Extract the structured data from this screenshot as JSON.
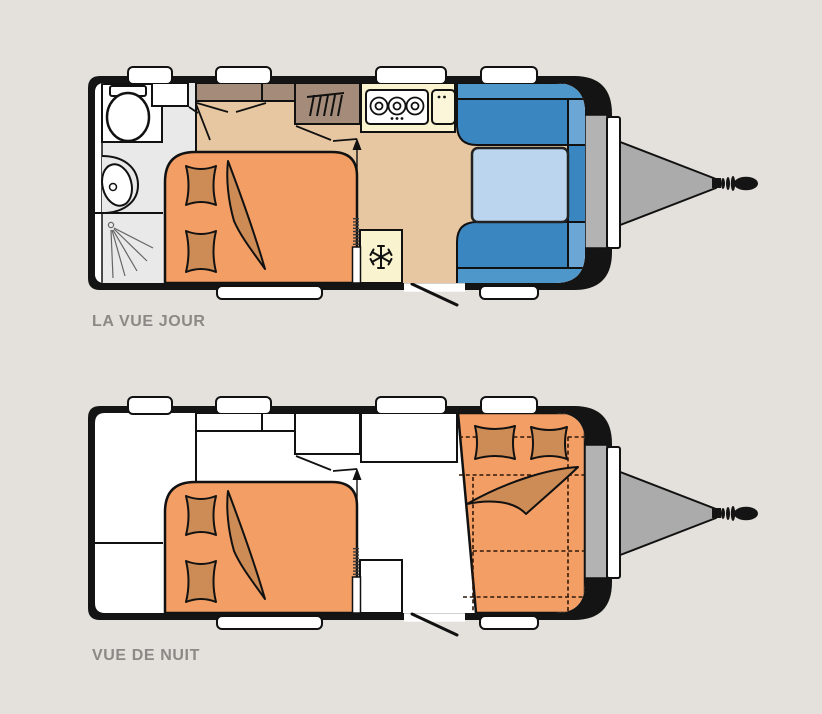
{
  "captions": {
    "day": "LA VUE JOUR",
    "night": "VUE DE NUIT"
  },
  "colors": {
    "bg": "#e4e1dc",
    "wall": "#141414",
    "line": "#111111",
    "floor": "#e7c7a1",
    "bath": "#e9e9e9",
    "wood": "#a58b79",
    "bed": "#f39e65",
    "bedding": "#cd8b55",
    "kitchen": "#faf3cf",
    "seat": "#3a86c0",
    "band": "#4e97cb",
    "arm": "#6ba6d4",
    "table": "#bcd5ee",
    "metal": "#ababab",
    "box": "#b3b3b3",
    "dash": "#30180a",
    "caption": "#8b8885",
    "spray": "#666666"
  },
  "icons": [
    "freezer-icon",
    "heater-grille-icon",
    "hob-burner-icon",
    "direction-arrow-icon",
    "door-swing-icon",
    "shower-spray-icon"
  ],
  "views": [
    {
      "id": "day",
      "label": "LA VUE JOUR",
      "features": [
        "bathroom with toilet, washbasin and shower",
        "wardrobe cabinets",
        "heater with grille",
        "double bed with 2 pillows and blanket",
        "kitchen with 3-burner hob and sink",
        "fridge with freezer symbol",
        "dinette with 2 bench seats and table",
        "4 top windows",
        "2 bottom windows",
        "entry door",
        "drawbar with hitch"
      ]
    },
    {
      "id": "night",
      "label": "VUE DE NUIT",
      "features": [
        "furniture shown as outlines",
        "double bed with 2 pillows and blanket",
        "dinette converted to second bed with 2 pillows, blanket and seam lines",
        "same windows, door and drawbar"
      ]
    }
  ]
}
